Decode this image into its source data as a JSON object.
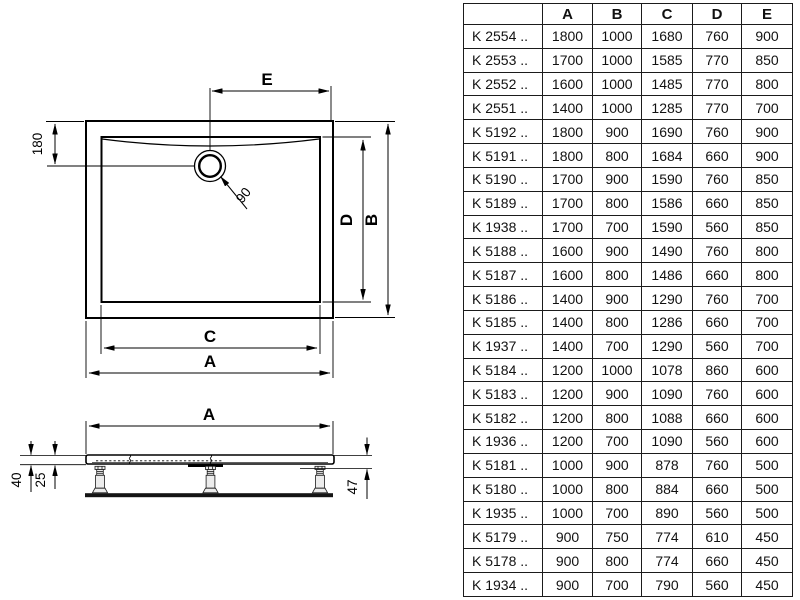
{
  "drawing": {
    "labels": {
      "e": "E",
      "dim180": "180",
      "dim90": "90",
      "d": "D",
      "b": "B",
      "c": "C",
      "a_top": "A",
      "a_side": "A",
      "dim40": "40",
      "dim25": "25",
      "dim47": "47"
    }
  },
  "table": {
    "col_headers": [
      "A",
      "B",
      "C",
      "D",
      "E"
    ],
    "rows": [
      {
        "model": "K 2554 ..",
        "values": [
          "1800",
          "1000",
          "1680",
          "760",
          "900"
        ]
      },
      {
        "model": "K 2553 ..",
        "values": [
          "1700",
          "1000",
          "1585",
          "770",
          "850"
        ]
      },
      {
        "model": "K 2552 ..",
        "values": [
          "1600",
          "1000",
          "1485",
          "770",
          "800"
        ]
      },
      {
        "model": "K 2551 ..",
        "values": [
          "1400",
          "1000",
          "1285",
          "770",
          "700"
        ]
      },
      {
        "model": "K 5192 ..",
        "values": [
          "1800",
          "900",
          "1690",
          "760",
          "900"
        ]
      },
      {
        "model": "K 5191 ..",
        "values": [
          "1800",
          "800",
          "1684",
          "660",
          "900"
        ]
      },
      {
        "model": "K 5190 ..",
        "values": [
          "1700",
          "900",
          "1590",
          "760",
          "850"
        ]
      },
      {
        "model": "K 5189 ..",
        "values": [
          "1700",
          "800",
          "1586",
          "660",
          "850"
        ]
      },
      {
        "model": "K 1938 ..",
        "values": [
          "1700",
          "700",
          "1590",
          "560",
          "850"
        ]
      },
      {
        "model": "K 5188 ..",
        "values": [
          "1600",
          "900",
          "1490",
          "760",
          "800"
        ]
      },
      {
        "model": "K 5187 ..",
        "values": [
          "1600",
          "800",
          "1486",
          "660",
          "800"
        ]
      },
      {
        "model": "K 5186 ..",
        "values": [
          "1400",
          "900",
          "1290",
          "760",
          "700"
        ]
      },
      {
        "model": "K 5185 ..",
        "values": [
          "1400",
          "800",
          "1286",
          "660",
          "700"
        ]
      },
      {
        "model": "K 1937 ..",
        "values": [
          "1400",
          "700",
          "1290",
          "560",
          "700"
        ]
      },
      {
        "model": "K 5184 ..",
        "values": [
          "1200",
          "1000",
          "1078",
          "860",
          "600"
        ]
      },
      {
        "model": "K 5183 ..",
        "values": [
          "1200",
          "900",
          "1090",
          "760",
          "600"
        ]
      },
      {
        "model": "K 5182 ..",
        "values": [
          "1200",
          "800",
          "1088",
          "660",
          "600"
        ]
      },
      {
        "model": "K 1936 ..",
        "values": [
          "1200",
          "700",
          "1090",
          "560",
          "600"
        ]
      },
      {
        "model": "K 5181 ..",
        "values": [
          "1000",
          "900",
          "878",
          "760",
          "500"
        ]
      },
      {
        "model": "K 5180 ..",
        "values": [
          "1000",
          "800",
          "884",
          "660",
          "500"
        ]
      },
      {
        "model": "K 1935 ..",
        "values": [
          "1000",
          "700",
          "890",
          "560",
          "500"
        ]
      },
      {
        "model": "K 5179 ..",
        "values": [
          "900",
          "750",
          "774",
          "610",
          "450"
        ]
      },
      {
        "model": "K 5178 ..",
        "values": [
          "900",
          "800",
          "774",
          "660",
          "450"
        ]
      },
      {
        "model": "K 1934 ..",
        "values": [
          "900",
          "700",
          "790",
          "560",
          "450"
        ]
      }
    ]
  }
}
